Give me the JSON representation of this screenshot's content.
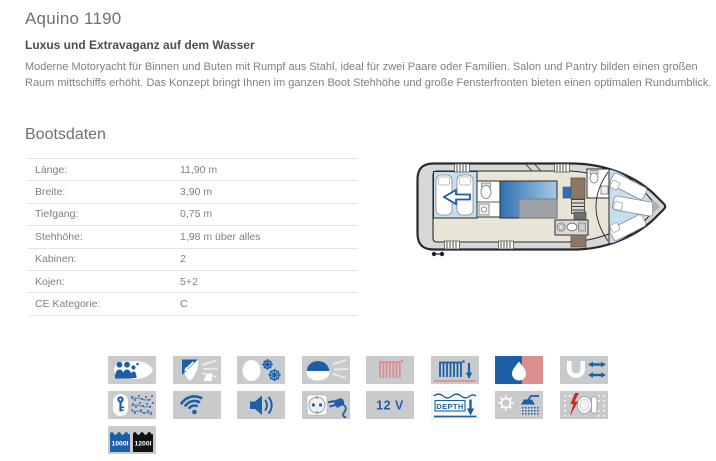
{
  "page": {
    "title": "Aquino 1190",
    "subtitle": "Luxus und Extravaganz auf dem Wasser",
    "description": "Moderne Motoryacht für Binnen und Buten mit Rumpf aus Stahl, ideal für zwei Paare oder Familien. Salon und Pantry bilden einen großen Raum mittschiffs erhöht. Das Konzept bringt Ihnen im ganzen Boot Stehhöhe und große Fensterfronten bieten einen optimalen Rundumblick."
  },
  "bootsdaten": {
    "heading": "Bootsdaten",
    "rows": [
      {
        "label": "Länge:",
        "value": "11,90 m"
      },
      {
        "label": "Breite:",
        "value": "3,90 m"
      },
      {
        "label": "Tiefgang:",
        "value": "0,75 m"
      },
      {
        "label": "Stehhöhe:",
        "value": "1,98 m über alles"
      },
      {
        "label": "Kabinen:",
        "value": "2"
      },
      {
        "label": "Kojen:",
        "value": "5+2"
      },
      {
        "label": "CE Kategorie:",
        "value": "C"
      }
    ]
  },
  "features": {
    "row1": [
      "crew-capacity",
      "bow-thruster",
      "twin-steering",
      "bimini-top",
      "heating-radiator",
      "warm-air-heating",
      "warm-water",
      "bow-and-stern-thruster"
    ],
    "row2": [
      "electronic-key",
      "wifi",
      "radio-audio",
      "shore-power-230v",
      "power-12v",
      "depth-sounder",
      "deck-shower",
      "electric-toilet"
    ],
    "row3": [
      "water-tank-capacity",
      "fuel-tank-capacity"
    ],
    "labels": {
      "volt": "12 V",
      "depth": "DEPTH",
      "water_tank": "1000l",
      "fuel_tank": "1200l"
    }
  },
  "colors": {
    "accent_blue": "#1d5fa6",
    "icon_background": "#c9cacb",
    "salmon_red": "#d9908e",
    "heading_gray": "#6f7173",
    "body_gray": "#7f8082"
  }
}
